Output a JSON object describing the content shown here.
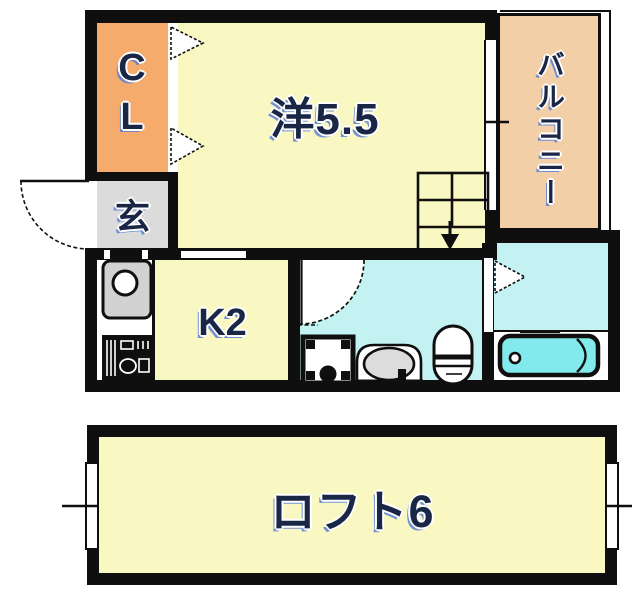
{
  "title": "apartment-floor-plan",
  "rooms": {
    "closet": {
      "label": "CL"
    },
    "western": {
      "label": "洋5.5"
    },
    "entrance": {
      "label": "玄"
    },
    "kitchen": {
      "label": "K2"
    },
    "balcony": {
      "label": "バルコニー"
    },
    "loft": {
      "label": "ロフト6"
    }
  },
  "palette": {
    "wall": "#0f0f0f",
    "room_yellow": "#faf8c2",
    "closet_orange": "#f5ab6b",
    "balcony_peach": "#f2cfa6",
    "wet_area_cyan": "#c4f1f2",
    "bathtub_cyan": "#82e9ec",
    "entrance_gray": "#dbdbdb",
    "label_navy": "#1a2645"
  },
  "fixtures": [
    "closet-folding-doors",
    "entry-door-swing",
    "staircase-down-arrow",
    "window-to-balcony",
    "kitchen-sink",
    "gas-stove",
    "washroom-door-swing",
    "washing-machine-pan",
    "washbasin",
    "toilet",
    "bathroom-door",
    "bathtub",
    "loft-windows"
  ]
}
